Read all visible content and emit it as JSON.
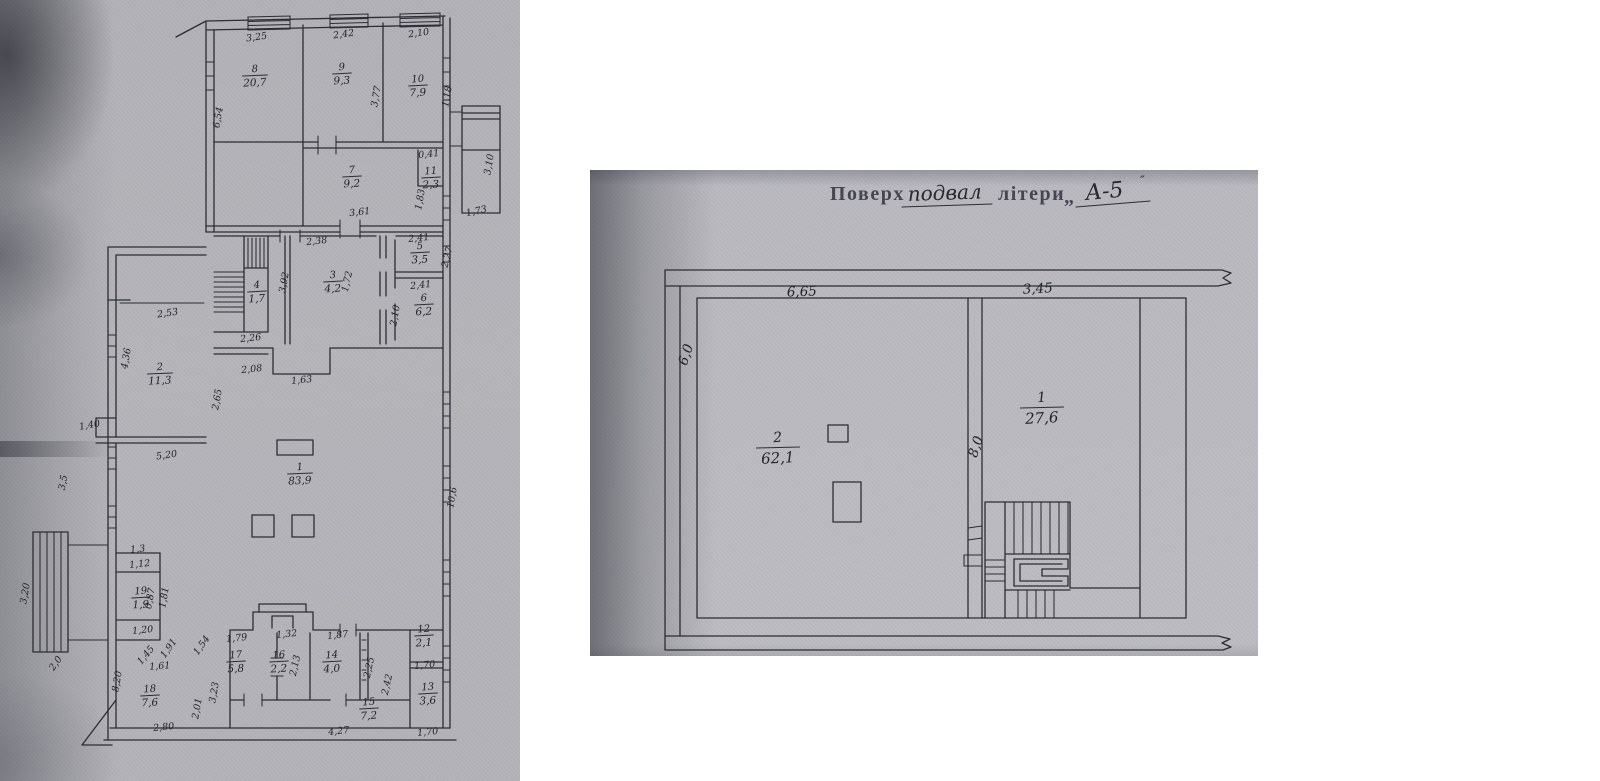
{
  "left_plan": {
    "rooms": [
      {
        "n": "1",
        "a": "83,9",
        "x": 300,
        "y": 470
      },
      {
        "n": "2",
        "a": "11,3",
        "x": 160,
        "y": 370
      },
      {
        "n": "3",
        "a": "4,2",
        "x": 333,
        "y": 278
      },
      {
        "n": "4",
        "a": "1,7",
        "x": 257,
        "y": 288
      },
      {
        "n": "5",
        "a": "3,5",
        "x": 420,
        "y": 249
      },
      {
        "n": "6",
        "a": "6,2",
        "x": 424,
        "y": 301
      },
      {
        "n": "7",
        "a": "9,2",
        "x": 352,
        "y": 173
      },
      {
        "n": "8",
        "a": "20,7",
        "x": 255,
        "y": 72
      },
      {
        "n": "9",
        "a": "9,3",
        "x": 342,
        "y": 70
      },
      {
        "n": "10",
        "a": "7,9",
        "x": 418,
        "y": 82
      },
      {
        "n": "11",
        "a": "2,3",
        "x": 431,
        "y": 174
      },
      {
        "n": "12",
        "a": "2,1",
        "x": 424,
        "y": 632
      },
      {
        "n": "13",
        "a": "3,6",
        "x": 428,
        "y": 690
      },
      {
        "n": "14",
        "a": "4,0",
        "x": 332,
        "y": 658
      },
      {
        "n": "15",
        "a": "7,2",
        "x": 369,
        "y": 705
      },
      {
        "n": "16",
        "a": "2,2",
        "x": 279,
        "y": 658
      },
      {
        "n": "17",
        "a": "5,8",
        "x": 236,
        "y": 658
      },
      {
        "n": "18",
        "a": "7,6",
        "x": 150,
        "y": 692
      },
      {
        "n": "19",
        "a": "1,9",
        "x": 141,
        "y": 594
      }
    ],
    "dims": [
      {
        "t": "3,25",
        "x": 257,
        "y": 40,
        "r": -8
      },
      {
        "t": "2,42",
        "x": 344,
        "y": 37,
        "r": -8
      },
      {
        "t": "2,10",
        "x": 419,
        "y": 36,
        "r": -8
      },
      {
        "t": "6,54",
        "x": 221,
        "y": 118,
        "r": -80
      },
      {
        "t": "3,77",
        "x": 379,
        "y": 97,
        "r": -80
      },
      {
        "t": "1,18",
        "x": 450,
        "y": 97,
        "r": -80
      },
      {
        "t": "0,41",
        "x": 429,
        "y": 157,
        "r": -6
      },
      {
        "t": "1,83",
        "x": 423,
        "y": 200,
        "r": -80
      },
      {
        "t": "3,10",
        "x": 492,
        "y": 165,
        "r": -80
      },
      {
        "t": "1,73",
        "x": 477,
        "y": 214,
        "r": -12
      },
      {
        "t": "3,61",
        "x": 360,
        "y": 215,
        "r": -6
      },
      {
        "t": "2,38",
        "x": 317,
        "y": 244,
        "r": -6
      },
      {
        "t": "2,41",
        "x": 419,
        "y": 241,
        "r": -6
      },
      {
        "t": "2,27",
        "x": 450,
        "y": 258,
        "r": -75
      },
      {
        "t": "2,41",
        "x": 421,
        "y": 288,
        "r": -6
      },
      {
        "t": "2,10",
        "x": 398,
        "y": 316,
        "r": -80
      },
      {
        "t": "1,72",
        "x": 350,
        "y": 282,
        "r": -78
      },
      {
        "t": "3,92",
        "x": 287,
        "y": 283,
        "r": -80
      },
      {
        "t": "2,26",
        "x": 251,
        "y": 341,
        "r": -6
      },
      {
        "t": "2,53",
        "x": 168,
        "y": 316,
        "r": -8
      },
      {
        "t": "2,08",
        "x": 252,
        "y": 372,
        "r": -6
      },
      {
        "t": "1,63",
        "x": 302,
        "y": 383,
        "r": -6
      },
      {
        "t": "2,65",
        "x": 220,
        "y": 400,
        "r": -80
      },
      {
        "t": "4,36",
        "x": 129,
        "y": 359,
        "r": -80
      },
      {
        "t": "1,40",
        "x": 90,
        "y": 428,
        "r": -10
      },
      {
        "t": "5,20",
        "x": 167,
        "y": 458,
        "r": -8
      },
      {
        "t": "3,5",
        "x": 66,
        "y": 483,
        "r": -80
      },
      {
        "t": "3,20",
        "x": 28,
        "y": 594,
        "r": -80
      },
      {
        "t": "2,0",
        "x": 58,
        "y": 665,
        "r": -55
      },
      {
        "t": "10,6",
        "x": 455,
        "y": 498,
        "r": -80
      },
      {
        "t": "1,3",
        "x": 138,
        "y": 552,
        "r": -6
      },
      {
        "t": "1,12",
        "x": 140,
        "y": 567,
        "r": -6
      },
      {
        "t": "0,87",
        "x": 153,
        "y": 599,
        "r": -80
      },
      {
        "t": "1,81",
        "x": 167,
        "y": 598,
        "r": -80
      },
      {
        "t": "1,20",
        "x": 143,
        "y": 633,
        "r": -6
      },
      {
        "t": "8,20",
        "x": 120,
        "y": 682,
        "r": -80
      },
      {
        "t": "1,61",
        "x": 160,
        "y": 669,
        "r": -4
      },
      {
        "t": "2,80",
        "x": 164,
        "y": 730,
        "r": -6
      },
      {
        "t": "1,45",
        "x": 148,
        "y": 657,
        "r": -50
      },
      {
        "t": "1,91",
        "x": 171,
        "y": 650,
        "r": -55
      },
      {
        "t": "1,54",
        "x": 204,
        "y": 647,
        "r": -55
      },
      {
        "t": "1,79",
        "x": 237,
        "y": 641,
        "r": -6
      },
      {
        "t": "3,23",
        "x": 217,
        "y": 693,
        "r": -80
      },
      {
        "t": "2,01",
        "x": 200,
        "y": 709,
        "r": -80
      },
      {
        "t": "1,32",
        "x": 287,
        "y": 637,
        "r": -6
      },
      {
        "t": "2,13",
        "x": 298,
        "y": 666,
        "r": -78
      },
      {
        "t": "1,87",
        "x": 338,
        "y": 638,
        "r": -6
      },
      {
        "t": "2,25",
        "x": 372,
        "y": 668,
        "r": -78
      },
      {
        "t": "2,42",
        "x": 390,
        "y": 685,
        "r": -78
      },
      {
        "t": "4,27",
        "x": 339,
        "y": 734,
        "r": -6
      },
      {
        "t": "1,70",
        "x": 425,
        "y": 668,
        "r": -6
      },
      {
        "t": "1,70",
        "x": 428,
        "y": 735,
        "r": -6
      }
    ]
  },
  "right_plan": {
    "title": {
      "stamp_prefix": "Поверх",
      "hand_floor": "подвал",
      "stamp_suffix": "літери",
      "open_quote": "„",
      "hand_letter": "А-5",
      "flourish": "″"
    },
    "rooms": [
      {
        "n": "2",
        "a": "62,1",
        "x": 188,
        "y": 272
      },
      {
        "n": "1",
        "a": "27,6",
        "x": 452,
        "y": 232
      }
    ],
    "dims": [
      {
        "t": "6,65",
        "x": 212,
        "y": 126,
        "r": -2
      },
      {
        "t": "3,45",
        "x": 448,
        "y": 123,
        "r": -3
      },
      {
        "t": "6,0",
        "x": 100,
        "y": 186,
        "r": -72
      },
      {
        "t": "8,0",
        "x": 390,
        "y": 278,
        "r": -72
      }
    ]
  },
  "colors": {
    "ink": "#2c2c34",
    "paper_left": "#b4b4b9",
    "paper_right": "#babac0",
    "page_background": "#ffffff"
  }
}
